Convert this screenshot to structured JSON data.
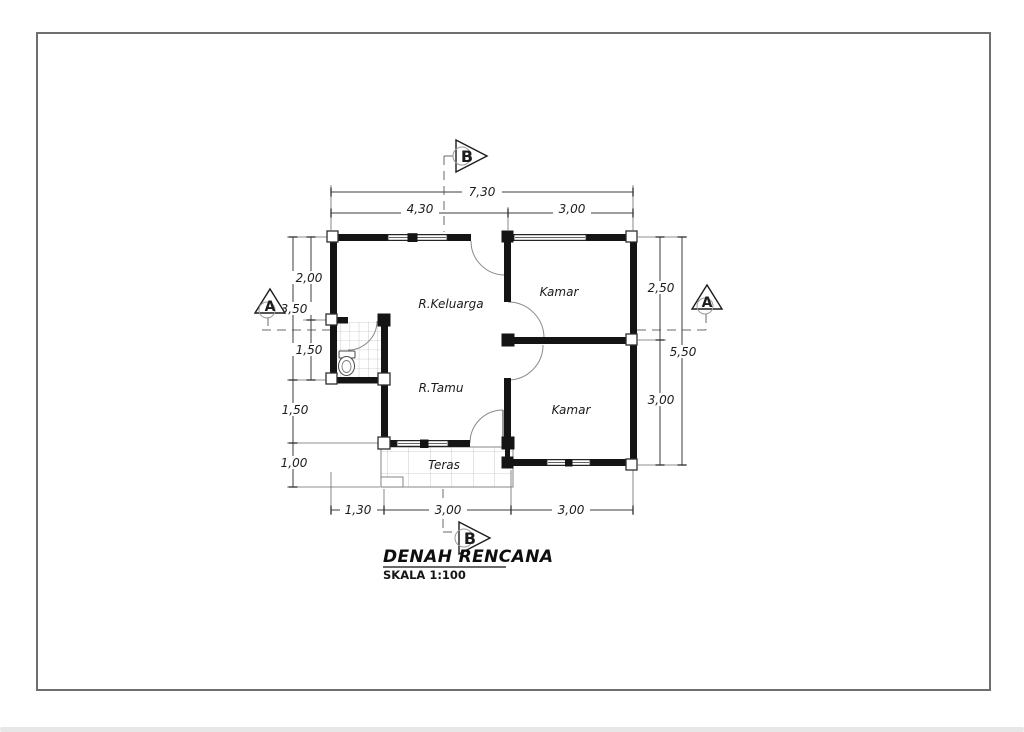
{
  "drawing": {
    "title": "DENAH RENCANA",
    "scale": "SKALA 1:100"
  },
  "rooms": {
    "keluarga": "R.Keluarga",
    "kamar_top": "Kamar",
    "tamu": "R.Tamu",
    "kamar_bottom": "Kamar",
    "teras": "Teras"
  },
  "markers": {
    "a": "A",
    "b": "B"
  },
  "dims": {
    "top_total": "7,30",
    "top_left": "4,30",
    "top_right": "3,00",
    "left_1": "2,00",
    "left_upper_total": "3,50",
    "left_2": "1,50",
    "left_3": "1,50",
    "left_4": "1,00",
    "right_1": "2,50",
    "right_total": "5,50",
    "right_2": "3,00",
    "bottom_1": "1,30",
    "bottom_2": "3,00",
    "bottom_3": "3,00"
  },
  "colors": {
    "wall": "#141414",
    "paper": "#ffffff",
    "frame": "#6f6f6f",
    "bottom_bar": "#e7e7e7"
  }
}
